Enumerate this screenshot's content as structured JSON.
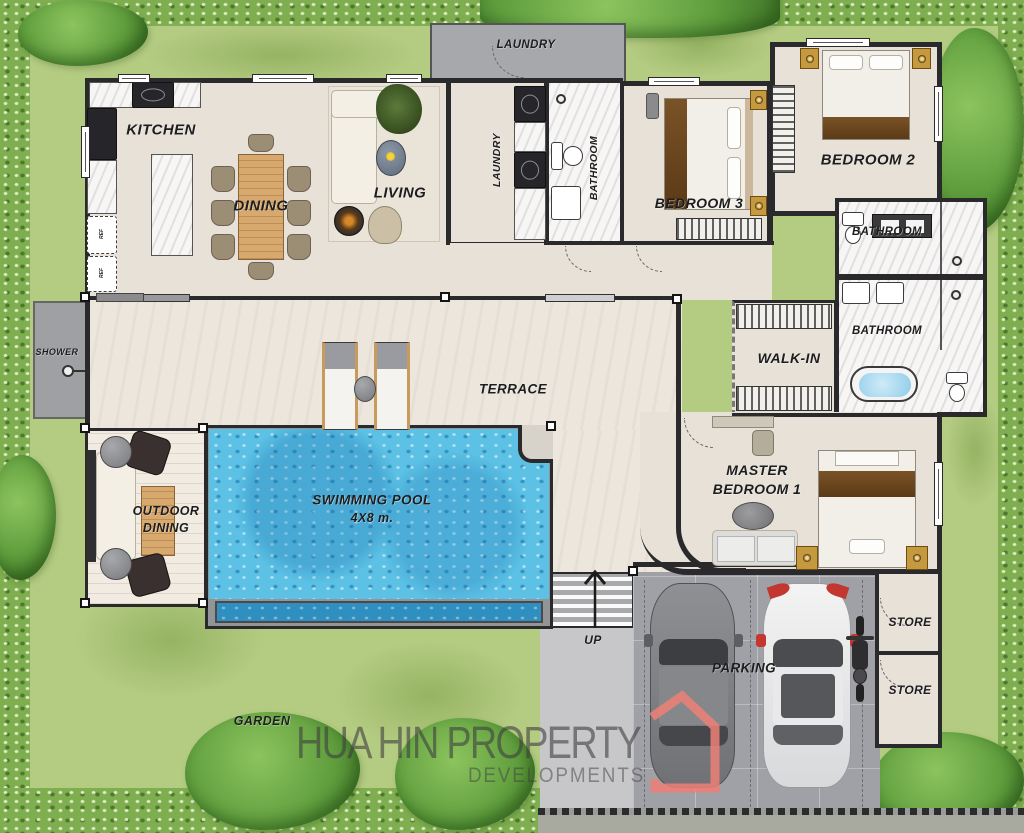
{
  "labels": {
    "kitchen": "KITCHEN",
    "dining": "DINING",
    "living": "LIVING",
    "laundry_outdoor": "LAUNDRY",
    "laundry_inner": "LAUNDRY",
    "bathroom_front": "BATHROOM",
    "bedroom3": "BEDROOM 3",
    "bedroom2": "BEDROOM 2",
    "bathroom_guest": "BATHROOM",
    "bathroom_master": "BATHROOM",
    "walk_in": "WALK-IN",
    "terrace": "TERRACE",
    "shower": "SHOWER",
    "outdoor_dining_line1": "OUTDOOR",
    "outdoor_dining_line2": "DINING",
    "pool_line1": "SWIMMING POOL",
    "pool_line2": "4X8 m.",
    "master_line1": "MASTER",
    "master_line2": "BEDROOM 1",
    "up": "UP",
    "parking": "PARKING",
    "store_upper": "STORE",
    "store_lower": "STORE",
    "garden": "GARDEN",
    "fridge_upper": "REF",
    "fridge_lower": "REF"
  },
  "watermark": {
    "line1": "HUA HIN PROPERTY",
    "line2": "DEVELOPMENTS"
  },
  "icons": {
    "up_arrow": "up-arrow",
    "shower_head": "shower-head",
    "brand_house": "house-outline"
  },
  "colors": {
    "grass": "#b4cb82",
    "grass_dark": "#769c42",
    "hedge": "#7fae50",
    "tree": "#5e9c3c",
    "floor": "#e7e1d7",
    "terrace": "#ece6dd",
    "deck": "#f1ebe1",
    "wall": "#2a2a2c",
    "pool_water": "#5cc1e5",
    "pool_ledge": "#2f8fc0",
    "concrete": "#a7a8ac",
    "wood": "#d8a96e",
    "logo_red": "#ee8077",
    "watermark_gray": "#3f3f3f"
  }
}
